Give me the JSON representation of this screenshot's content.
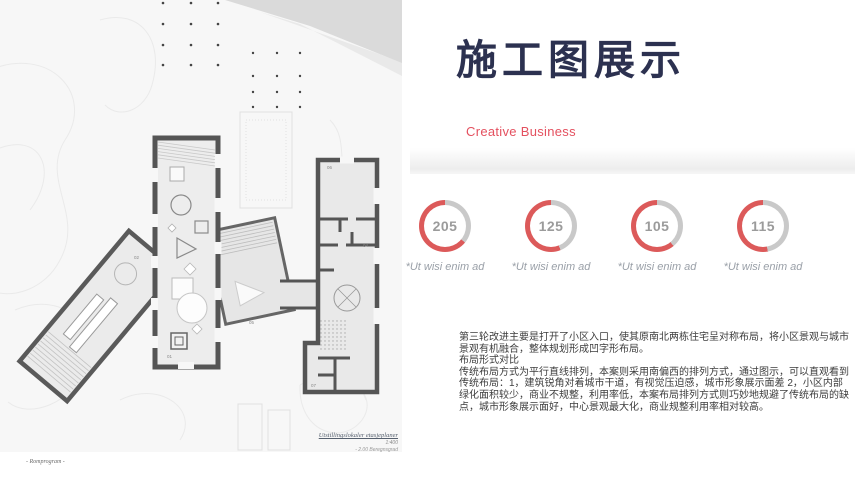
{
  "header": {
    "title": "施工图展示",
    "subtitle": "Creative Business"
  },
  "stats": {
    "items": [
      {
        "value": "205",
        "label": "*Ut wisi enim ad",
        "red_pct": 64
      },
      {
        "value": "125",
        "label": "*Ut wisi enim ad",
        "red_pct": 56
      },
      {
        "value": "105",
        "label": "*Ut wisi enim ad",
        "red_pct": 61
      },
      {
        "value": "115",
        "label": "*Ut wisi enim ad",
        "red_pct": 53
      }
    ]
  },
  "body": {
    "paragraphs": [
      "第三轮改进主要是打开了小区入口，使其原南北两栋住宅呈对称布局，将小区景观与城市景观有机融合，整体规划形成凹字形布局。",
      "布局形式对比",
      "传统布局方式为平行直线排列，本案则采用南偏西的排列方式，通过图示，可以直观看到传统布局：1，建筑锐角对着城市干道，有视觉压迫感，城市形象展示面差 2，小区内部绿化面积较少，商业不规整，利用率低，本案布局排列方式则巧妙地规避了传统布局的缺点，城市形象展示面好，中心景观最大化，商业规整利用率相对较高。"
    ]
  },
  "plan": {
    "caption_title": "Utstillingslokaler etasjeplaner",
    "caption_scale": "1:400",
    "caption_note": "- 2.00 Beregnsgrad",
    "footer": "- Romprogram -",
    "labels": [
      {
        "t": "01"
      },
      {
        "t": "02"
      },
      {
        "t": "04"
      },
      {
        "t": "05"
      },
      {
        "t": "06"
      },
      {
        "t": "07"
      }
    ]
  },
  "colors": {
    "title_navy": "#2c3150",
    "accent_red": "#e4505f",
    "ring_red": "#dc5a5a",
    "ring_gray": "#c9c9c9",
    "value_gray": "#9b9b9b"
  }
}
